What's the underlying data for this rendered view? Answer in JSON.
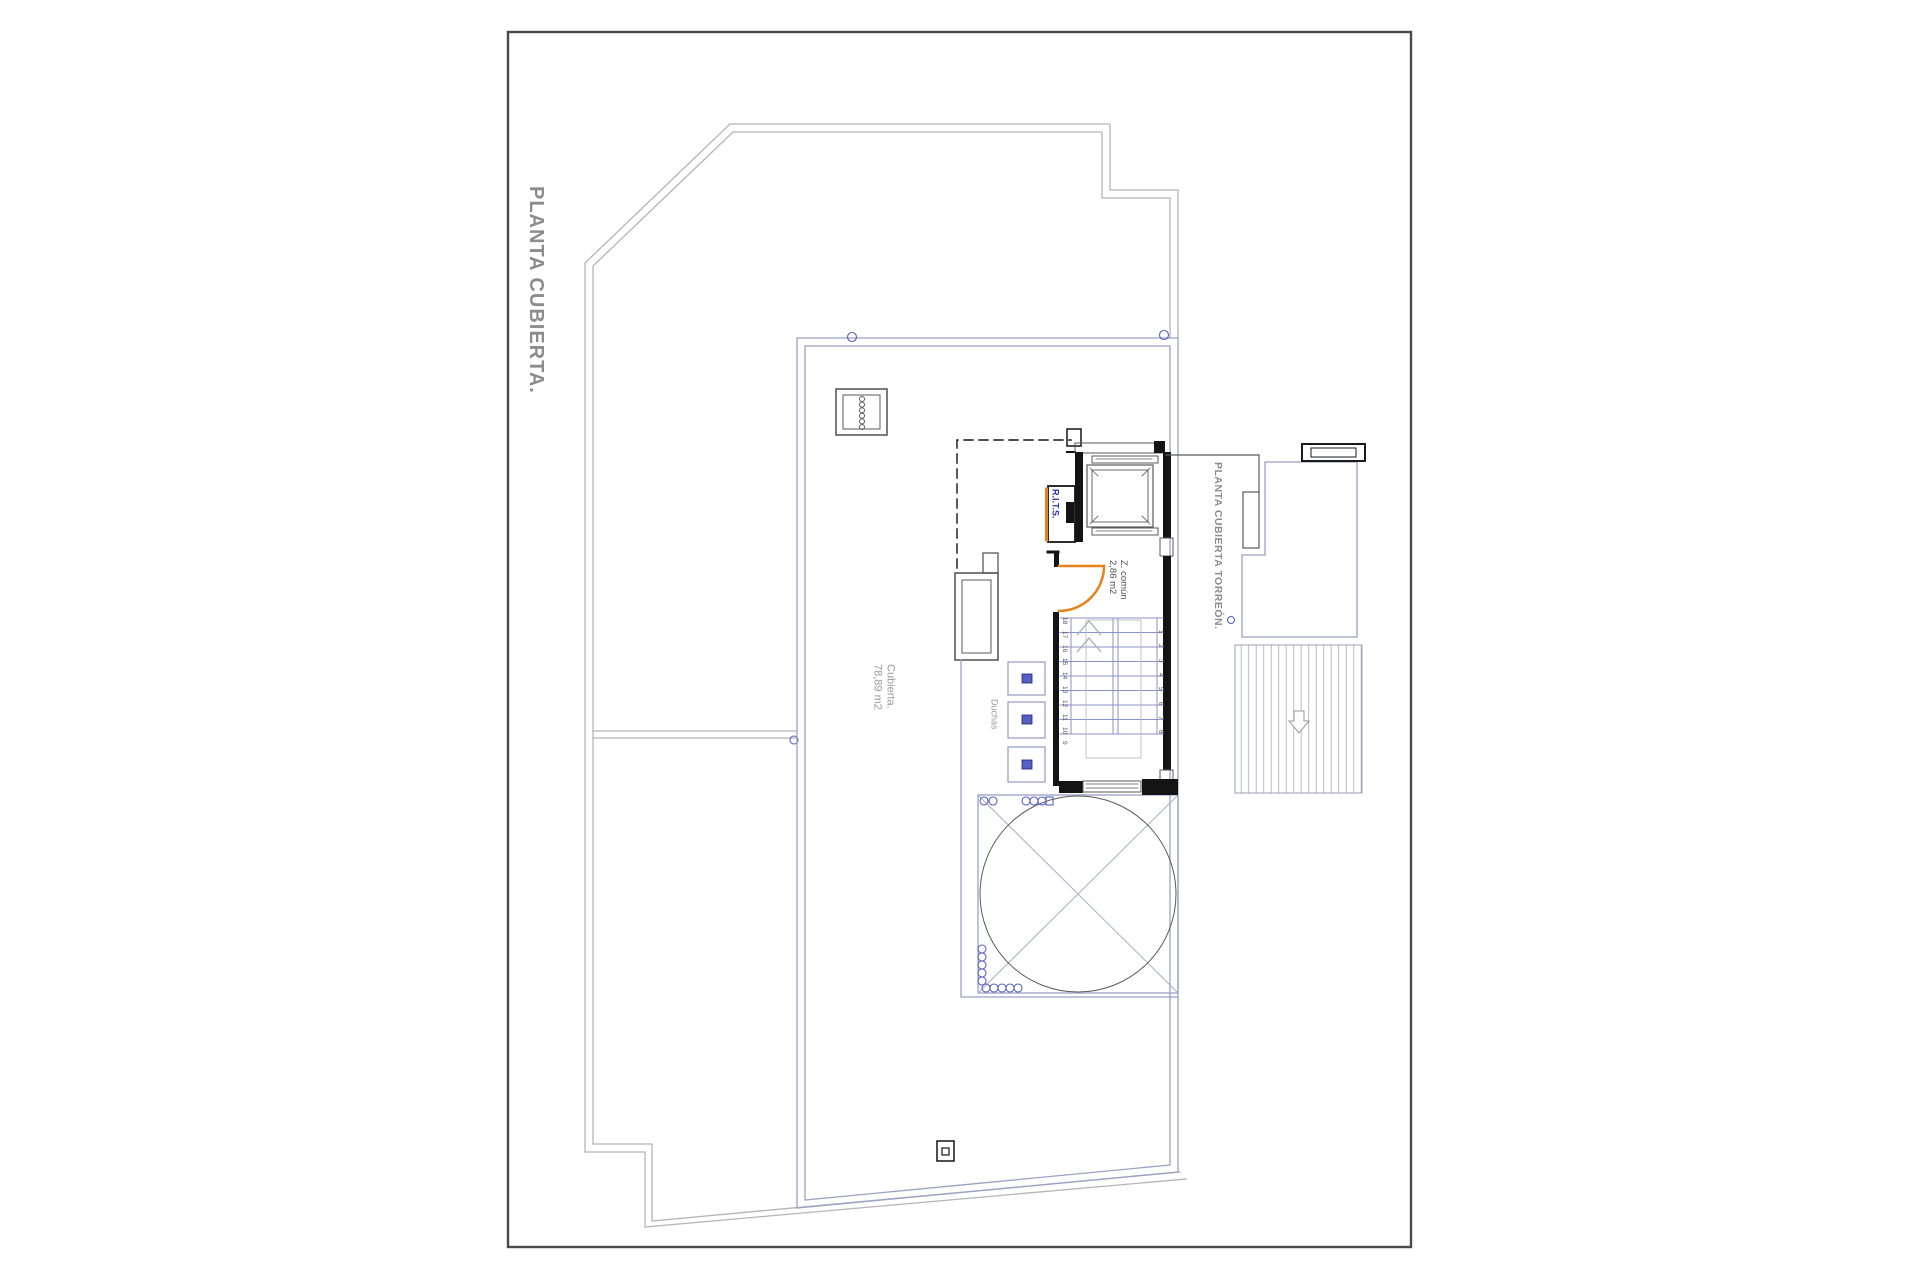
{
  "titles": {
    "main": "PLANTA CUBIERTA.",
    "torreon": "PLANTA CUBIERTA TORREÓN."
  },
  "labels": {
    "cubierta_line1": "Cubierta.",
    "cubierta_line2": "78,89 m2",
    "z_comun_line1": "Z. común",
    "z_comun_line2": "2,86 m2",
    "duchas": "Duchas",
    "rits": "R.I.T.S."
  },
  "stairs": {
    "left_numbers": [
      "18",
      "17",
      "16",
      "15",
      "14",
      "13",
      "12",
      "11",
      "10",
      "9"
    ],
    "right_numbers": [
      "1",
      "2",
      "3",
      "4",
      "5",
      "6",
      "7",
      "8"
    ]
  },
  "colors": {
    "frame": "#4a4a4a",
    "outer_wall": "#b5b5b5",
    "terrace_wall": "#9aa2c6",
    "stair_line": "#8a92ca",
    "core_wall": "#141414",
    "detail_line": "#5a5a5a",
    "door_orange": "#e8821e",
    "rits_blue": "#2433c0",
    "fitting_blue": "#5560c0",
    "title_gray": "#8c8c8c",
    "label_gray": "#9a9a9a",
    "hatch_line": "#b6bcd6"
  }
}
